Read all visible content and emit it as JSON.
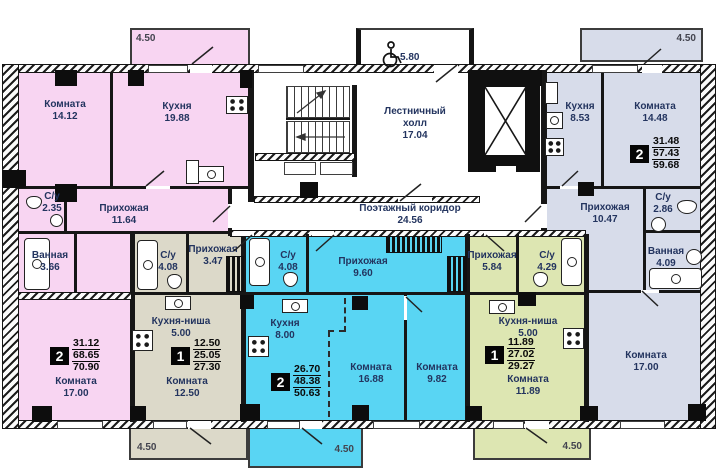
{
  "colors": {
    "apt_pink": "#f8d5f2",
    "apt_beige": "#dcd9c9",
    "apt_blue": "#59d5f3",
    "apt_green": "#dde6b2",
    "apt_gray": "#d7dcea",
    "wall": "#161616",
    "room_text": "#23345f"
  },
  "common": {
    "stair_hall": {
      "line1": "Лестничный",
      "line2": "холл",
      "area": "17.04"
    },
    "corridor": {
      "label": "Поэтажный коридор",
      "area": "24.56"
    },
    "accessible_balcony_area": "5.80"
  },
  "balconies": {
    "top_left": "4.50",
    "top_right": "4.50",
    "bottom_left": "4.50",
    "bottom_center": "4.50",
    "bottom_right": "4.50"
  },
  "apartments": [
    {
      "color": "#f8d5f2",
      "badge": {
        "rooms": "2",
        "living": "31.12",
        "apartment": "68.65",
        "total": "70.90"
      },
      "rooms": [
        {
          "label": "Комната",
          "area": "14.12"
        },
        {
          "label": "Кухня",
          "area": "19.88"
        },
        {
          "label": "С/у",
          "area": "2.35"
        },
        {
          "label": "Прихожая",
          "area": "11.64"
        },
        {
          "label": "Ванная",
          "area": "3.66"
        },
        {
          "label": "Комната",
          "area": "17.00"
        }
      ]
    },
    {
      "color": "#dcd9c9",
      "badge": {
        "rooms": "1",
        "living": "12.50",
        "apartment": "25.05",
        "total": "27.30"
      },
      "rooms": [
        {
          "label": "С/у",
          "area": "4.08"
        },
        {
          "label": "Прихожая",
          "area": "3.47"
        },
        {
          "label": "Кухня-ниша",
          "area": "5.00"
        },
        {
          "label": "Комната",
          "area": "12.50"
        }
      ]
    },
    {
      "color": "#59d5f3",
      "badge": {
        "rooms": "2",
        "living": "26.70",
        "apartment": "48.38",
        "total": "50.63"
      },
      "rooms": [
        {
          "label": "С/у",
          "area": "4.08"
        },
        {
          "label": "Прихожая",
          "area": "9.60"
        },
        {
          "label": "Кухня",
          "area": "8.00"
        },
        {
          "label": "Комната",
          "area": "16.88"
        },
        {
          "label": "Комната",
          "area": "9.82"
        }
      ]
    },
    {
      "color": "#dde6b2",
      "badge": {
        "rooms": "1",
        "living": "11.89",
        "apartment": "27.02",
        "total": "29.27"
      },
      "rooms": [
        {
          "label": "Прихожая",
          "area": "5.84"
        },
        {
          "label": "С/у",
          "area": "4.29"
        },
        {
          "label": "Кухня-ниша",
          "area": "5.00"
        },
        {
          "label": "Комната",
          "area": "11.89"
        }
      ]
    },
    {
      "color": "#d7dcea",
      "badge": {
        "rooms": "2",
        "living": "31.48",
        "apartment": "57.43",
        "total": "59.68"
      },
      "rooms": [
        {
          "label": "Кухня",
          "area": "8.53"
        },
        {
          "label": "Комната",
          "area": "14.48"
        },
        {
          "label": "Прихожая",
          "area": "10.47"
        },
        {
          "label": "С/у",
          "area": "2.86"
        },
        {
          "label": "Ванная",
          "area": "4.09"
        },
        {
          "label": "Комната",
          "area": "17.00"
        }
      ]
    }
  ]
}
